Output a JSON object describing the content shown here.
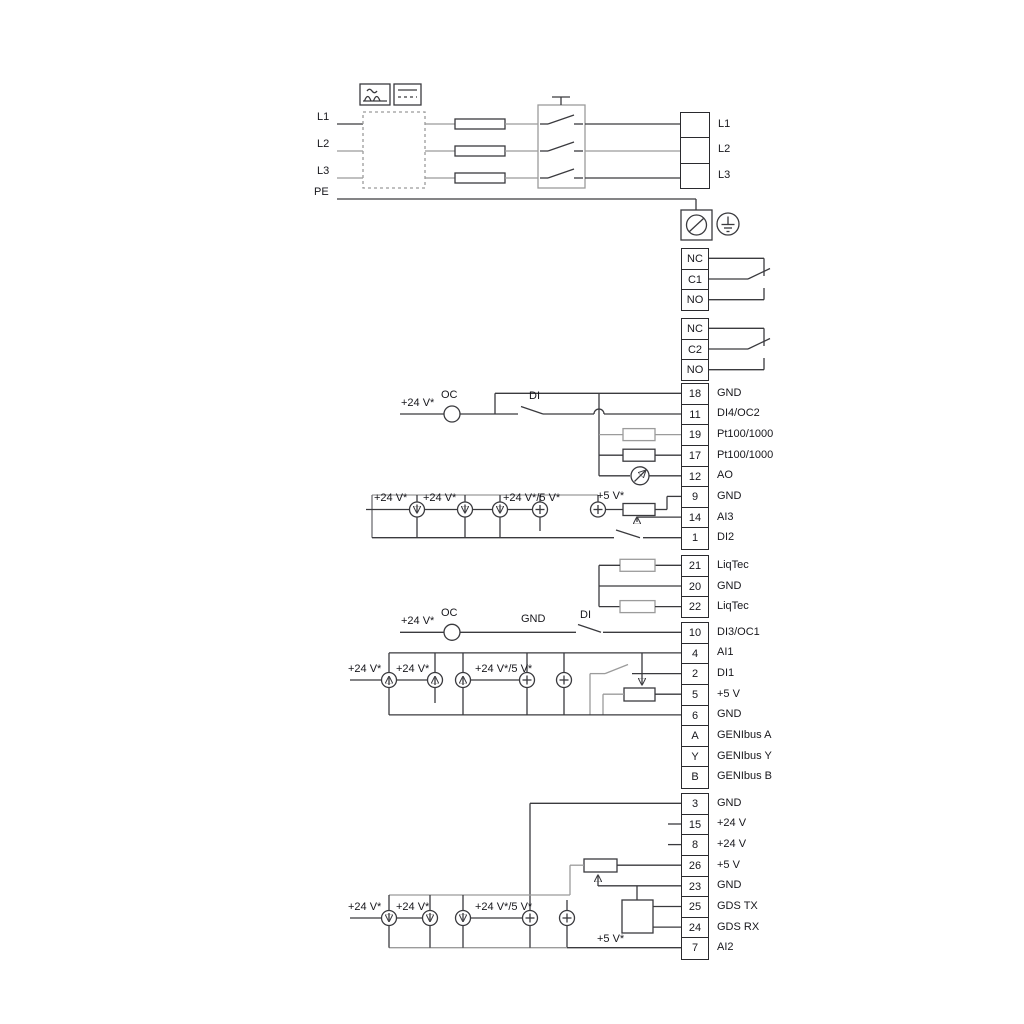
{
  "diagram_title": "drive-power-and-io-wiring-diagram",
  "labels": {
    "l1": "L1",
    "l2": "L2",
    "l3": "L3",
    "pe": "PE",
    "v24": "+24 V*",
    "v24_5": "+24 V*/5 V*",
    "v5": "+5 V*",
    "oc": "OC",
    "di": "DI",
    "gnd": "GND"
  },
  "strips": [
    {
      "name": "mains-output-block",
      "rows": [
        {
          "pin": "",
          "label": "L1"
        },
        {
          "pin": "",
          "label": "L2"
        },
        {
          "pin": "",
          "label": "L3"
        }
      ]
    },
    {
      "name": "relay-1",
      "rows": [
        {
          "pin": "NC",
          "label": ""
        },
        {
          "pin": "C1",
          "label": ""
        },
        {
          "pin": "NO",
          "label": ""
        }
      ]
    },
    {
      "name": "relay-2",
      "rows": [
        {
          "pin": "NC",
          "label": ""
        },
        {
          "pin": "C2",
          "label": ""
        },
        {
          "pin": "NO",
          "label": ""
        }
      ]
    },
    {
      "name": "io-strip-1",
      "rows": [
        {
          "pin": "18",
          "label": "GND"
        },
        {
          "pin": "11",
          "label": "DI4/OC2"
        },
        {
          "pin": "19",
          "label": "Pt100/1000"
        },
        {
          "pin": "17",
          "label": "Pt100/1000"
        },
        {
          "pin": "12",
          "label": "AO"
        },
        {
          "pin": "9",
          "label": "GND"
        },
        {
          "pin": "14",
          "label": "AI3"
        },
        {
          "pin": "1",
          "label": "DI2"
        }
      ]
    },
    {
      "name": "liqtec-strip",
      "rows": [
        {
          "pin": "21",
          "label": "LiqTec"
        },
        {
          "pin": "20",
          "label": "GND"
        },
        {
          "pin": "22",
          "label": "LiqTec"
        }
      ]
    },
    {
      "name": "io-strip-2",
      "rows": [
        {
          "pin": "10",
          "label": "DI3/OC1"
        },
        {
          "pin": "4",
          "label": "AI1"
        },
        {
          "pin": "2",
          "label": "DI1"
        },
        {
          "pin": "5",
          "label": "+5 V"
        },
        {
          "pin": "6",
          "label": "GND"
        },
        {
          "pin": "A",
          "label": "GENIbus A"
        },
        {
          "pin": "Y",
          "label": "GENIbus Y"
        },
        {
          "pin": "B",
          "label": "GENIbus B"
        }
      ]
    },
    {
      "name": "io-strip-3",
      "rows": [
        {
          "pin": "3",
          "label": "GND"
        },
        {
          "pin": "15",
          "label": "+24 V"
        },
        {
          "pin": "8",
          "label": "+24 V"
        },
        {
          "pin": "26",
          "label": "+5 V"
        },
        {
          "pin": "23",
          "label": "GND"
        },
        {
          "pin": "25",
          "label": "GDS TX"
        },
        {
          "pin": "24",
          "label": "GDS RX"
        },
        {
          "pin": "7",
          "label": "AI2"
        }
      ]
    }
  ]
}
